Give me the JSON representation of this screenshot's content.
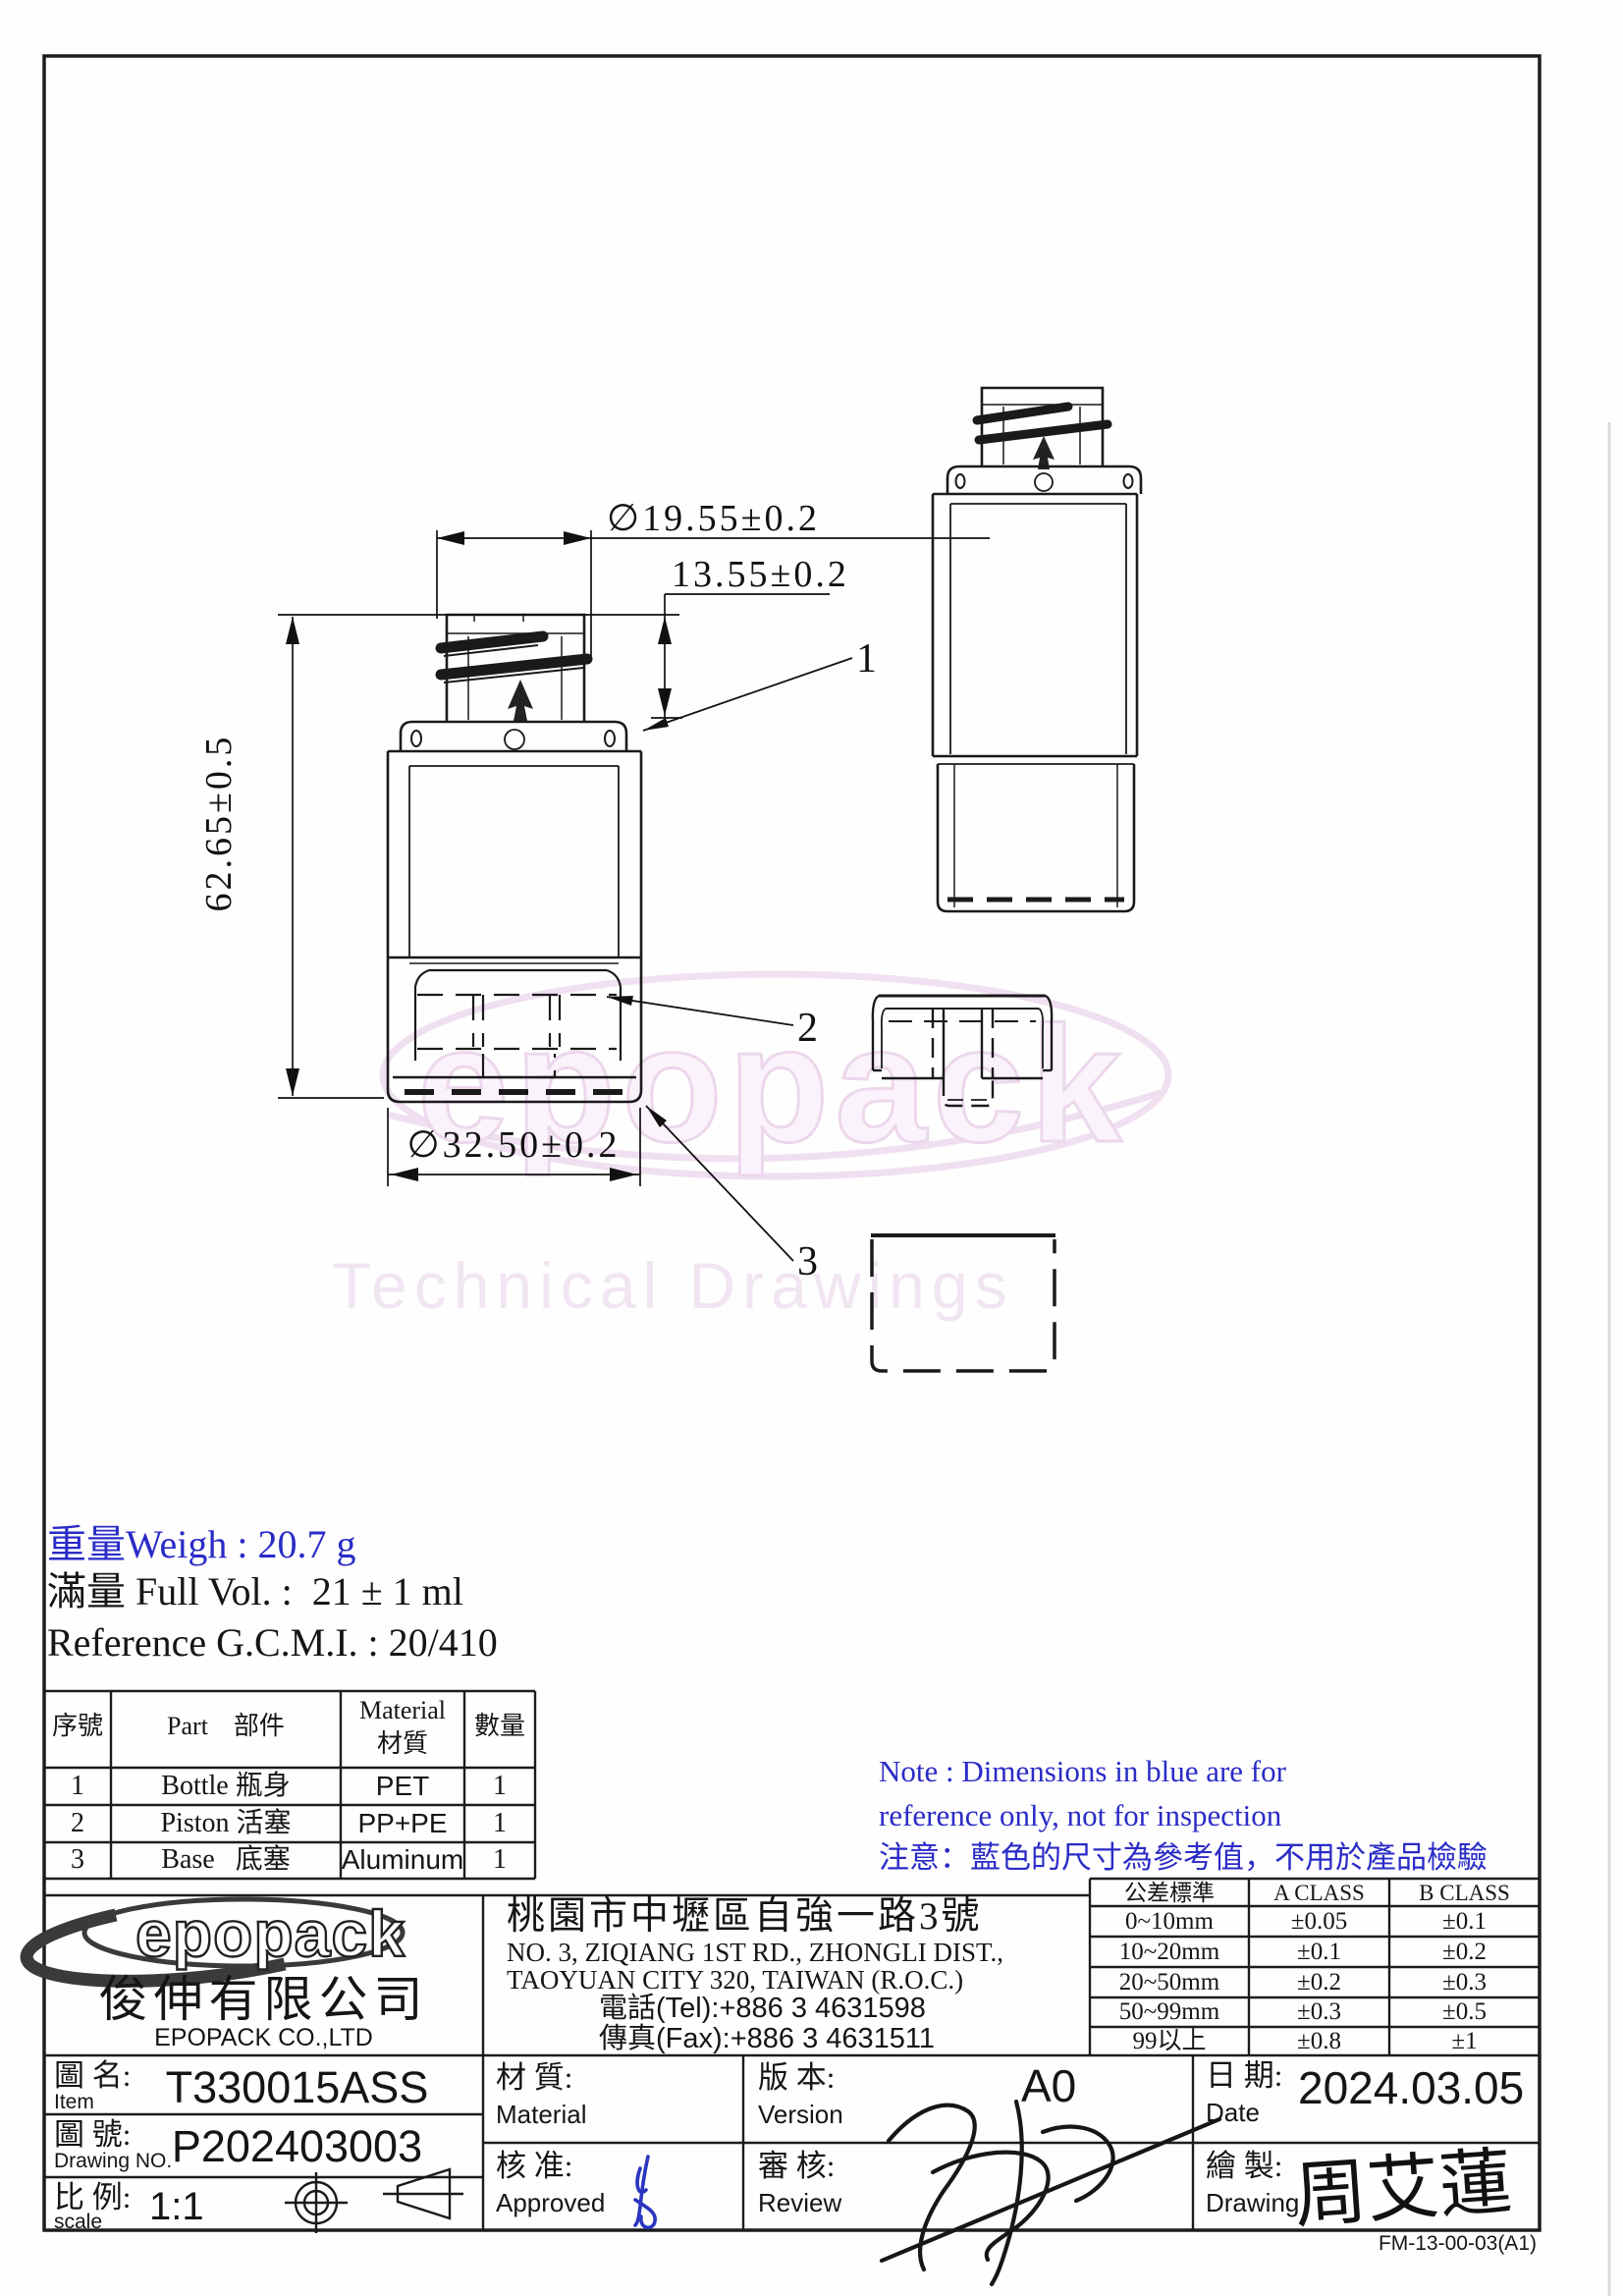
{
  "colors": {
    "reference_blue": "#2a2bc7",
    "line": "#1c1c1c",
    "watermark_pink": "#eedaee"
  },
  "watermark": {
    "brand": "epopack",
    "caption": "Technical Drawings"
  },
  "info": {
    "weight": "重量Weigh : 20.7 g",
    "full_volume": "滿量 Full Vol. :  21 ± 1 ml",
    "reference": "Reference G.C.M.I. : 20/410"
  },
  "drawing": {
    "dim_thread_diameter": "∅19.55±0.2",
    "dim_neck_height": "13.55±0.2",
    "dim_total_height": "62.65±0.5",
    "dim_body_diameter": "∅32.50±0.2",
    "callout_bottle": "1",
    "callout_piston": "2",
    "callout_base": "3"
  },
  "parts_table": {
    "header": {
      "no": "序號",
      "part": "Part    部件",
      "material_en": "Material",
      "material_zh": "材質",
      "qty": "數量"
    },
    "rows": [
      {
        "no": "1",
        "part": "Bottle 瓶身",
        "material": "PET",
        "qty": "1"
      },
      {
        "no": "2",
        "part": "Piston 活塞",
        "material": "PP+PE",
        "qty": "1"
      },
      {
        "no": "3",
        "part": "Base   底塞",
        "material": "Aluminum",
        "qty": "1"
      }
    ]
  },
  "note": {
    "line1": "Note : Dimensions in blue are for",
    "line2": "reference only, not for inspection",
    "line3": "注意：藍色的尺寸為參考值，不用於產品檢驗"
  },
  "company": {
    "logo": "epopack",
    "name_zh": "俊伸有限公司",
    "name_en": "EPOPACK CO.,LTD"
  },
  "address": {
    "line_zh": "桃園市中壢區自強一路3號",
    "line_en1": "NO. 3, ZIQIANG 1ST RD., ZHONGLI DIST.,",
    "line_en2": "TAOYUAN CITY 320, TAIWAN (R.O.C.)",
    "tel": "電話(Tel):+886 3 4631598",
    "fax": "傳真(Fax):+886 3 4631511"
  },
  "tolerance_table": {
    "headers": [
      "公差標準",
      "A CLASS",
      "B CLASS"
    ],
    "rows": [
      [
        "0~10mm",
        "±0.05",
        "±0.1"
      ],
      [
        "10~20mm",
        "±0.1",
        "±0.2"
      ],
      [
        "20~50mm",
        "±0.2",
        "±0.3"
      ],
      [
        "50~99mm",
        "±0.3",
        "±0.5"
      ],
      [
        "99以上",
        "±0.8",
        "±1"
      ]
    ]
  },
  "title_block": {
    "item_zh": "圖 名:",
    "item_en": "Item",
    "item_value": "T330015ASS",
    "no_zh": "圖 號:",
    "no_en": "Drawing NO.",
    "no_value": "P202403003",
    "scale_zh": "比 例:",
    "scale_en": "scale",
    "scale_value": "1:1",
    "material_zh": "材 質:",
    "material_en": "Material",
    "material_value": "",
    "version_zh": "版 本:",
    "version_en": "Version",
    "version_value": "A0",
    "date_zh": "日 期:",
    "date_en": "Date",
    "date_value": "2024.03.05",
    "approved_zh": "核 准:",
    "approved_en": "Approved",
    "review_zh": "審 核:",
    "review_en": "Review",
    "draw_zh": "繪 製:",
    "draw_en": "Drawing",
    "draw_signature": "周艾蓮"
  },
  "footer": {
    "form_no": "FM-13-00-03(A1)"
  }
}
